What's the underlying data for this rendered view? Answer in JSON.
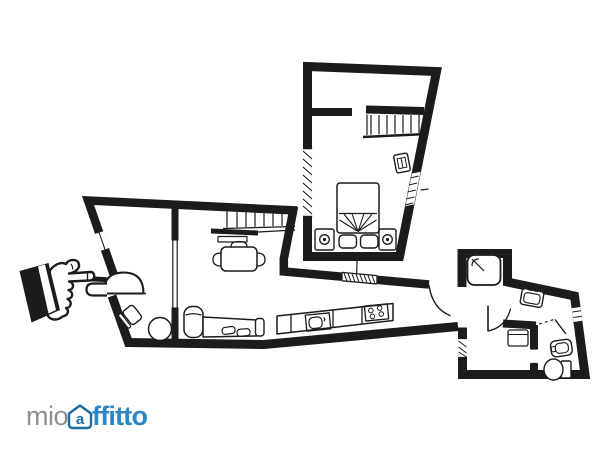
{
  "colors": {
    "background": "#ffffff",
    "ink": "#1c1c1c",
    "brand_gray": "#8e8e8e",
    "brand_blue": "#2e87c5",
    "brand_dark_blue": "#1e6ba3"
  },
  "watermark": {
    "prefix": "mio",
    "symbol_letter": "a",
    "suffix": "ffitto",
    "full_name": "mioaffitto",
    "symbol": "house-at-sign-icon"
  },
  "floor_plan": {
    "type": "apartment-floor-plan",
    "style": "black-and-white architectural line drawing",
    "rooms": [
      "upper-bedroom",
      "living-room",
      "entry-room",
      "kitchen-corridor",
      "bathroom",
      "wc"
    ],
    "elements": [
      "double-bed",
      "pillows",
      "nightstands-with-lamps",
      "bedroom-stairs",
      "tv-unit",
      "living-room-stairs",
      "wall-shelf",
      "dining-table-with-chairs",
      "sofa-with-chaise",
      "round-table",
      "armchair",
      "entrance-door-arc",
      "entrance-step",
      "kitchen-counter",
      "kitchen-sink",
      "stove-four-burners",
      "corridor-door-arc",
      "shower",
      "washbasin",
      "bathroom-door-arc",
      "washing-machine",
      "bidet",
      "toilet",
      "window-hatches"
    ]
  },
  "pointer": {
    "icon": "pointing-hand-icon",
    "direction": "right",
    "target": "entrance-door"
  }
}
